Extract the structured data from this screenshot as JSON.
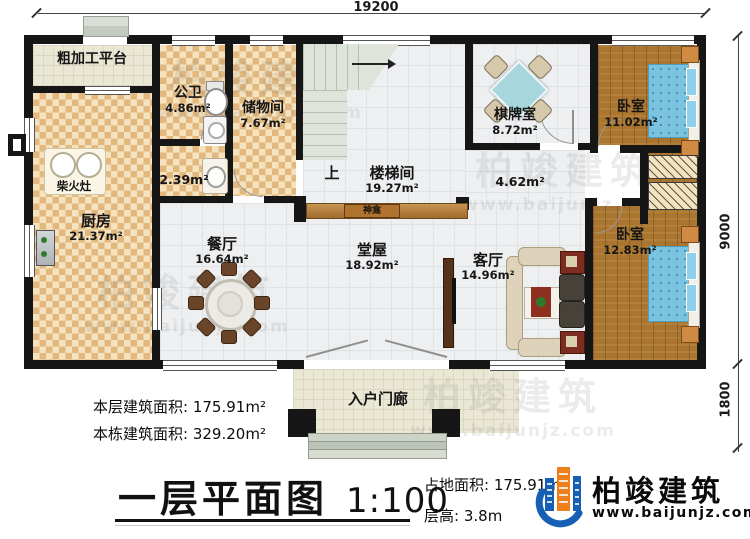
{
  "dimensions": {
    "top": "19200",
    "right_upper": "9000",
    "right_lower": "1800"
  },
  "rooms": {
    "platform": {
      "name": "粗加工平台"
    },
    "bath": {
      "name": "公卫",
      "area": "4.86m²"
    },
    "storage": {
      "name": "储物间",
      "area": "7.67m²"
    },
    "utility": {
      "area": "2.39m²"
    },
    "stove": {
      "name": "柴火灶"
    },
    "kitchen": {
      "name": "厨房",
      "area": "21.37m²"
    },
    "stairwell": {
      "name": "楼梯间",
      "area": "19.27m²",
      "up": "上"
    },
    "chess": {
      "name": "棋牌室",
      "area": "8.72m²"
    },
    "bedroom_top": {
      "name": "卧室",
      "area": "11.02m²"
    },
    "corridor": {
      "area": "4.62m²"
    },
    "shrine": {
      "name": "神龛"
    },
    "dining": {
      "name": "餐厅",
      "area": "16.64m²"
    },
    "hall": {
      "name": "堂屋",
      "area": "18.92m²"
    },
    "living": {
      "name": "客厅",
      "area": "14.96m²"
    },
    "bedroom_bottom": {
      "name": "卧室",
      "area": "12.83m²"
    },
    "porch": {
      "name": "入户门廊"
    }
  },
  "footer": {
    "floor_area_label": "本层建筑面积:",
    "floor_area_value": "175.91m²",
    "total_area_label": "本栋建筑面积:",
    "total_area_value": "329.20m²",
    "title": "一层平面图",
    "scale": "1:100",
    "site_area_label": "占地面积:",
    "site_area_value": "175.91m²",
    "height_label": "层高:",
    "height_value": "3.8m"
  },
  "brand": {
    "name": "柏竣建筑",
    "website": "www.baijunjz.com"
  },
  "watermark": {
    "name": "柏竣建筑",
    "website": "www.baijunjz.com"
  }
}
